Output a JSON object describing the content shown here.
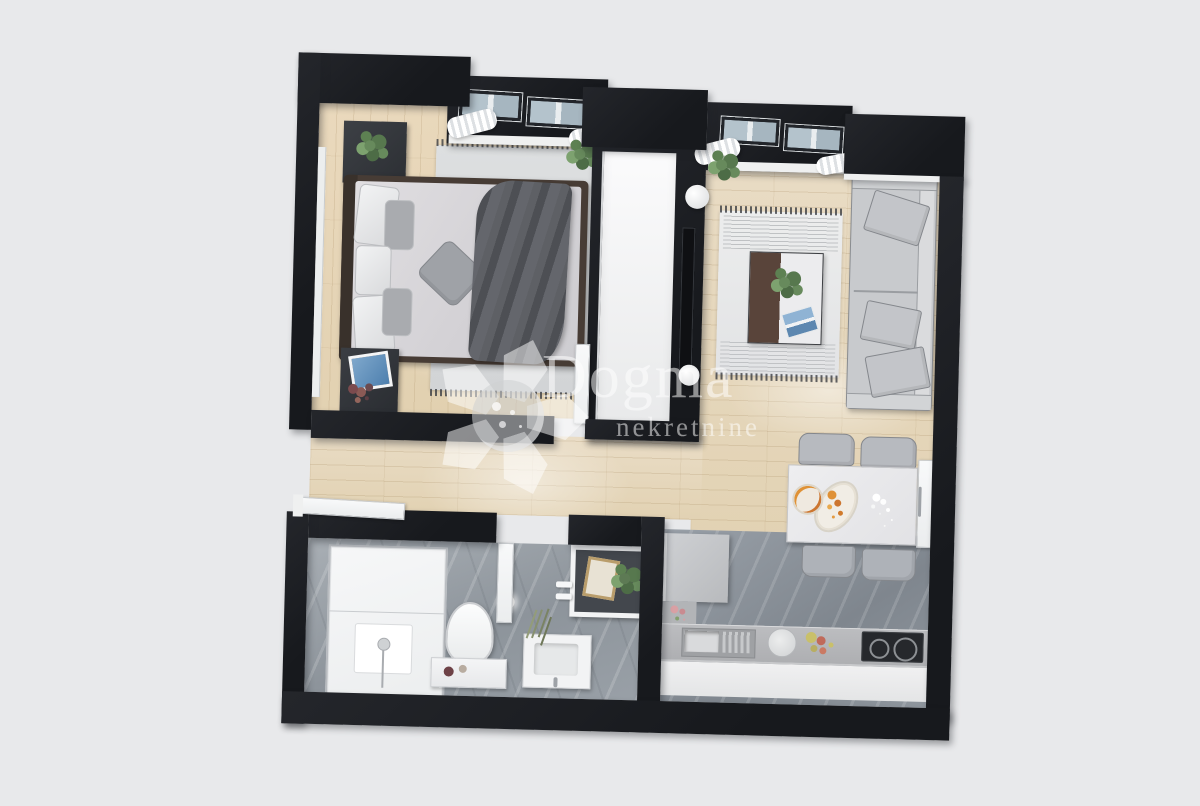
{
  "watermark": {
    "brand": "Dogma",
    "tagline": "nekretnine"
  },
  "palette": {
    "background": "#e8e9eb",
    "wall": "#1d1f24",
    "wood_floor": "#e6d9c1",
    "stone_floor": "#99a0a7",
    "shower_white": "#f3f4f5",
    "sofa_gray": "#c8cacd",
    "bed_duvet": "#dad8db",
    "blanket_dark": "#55575c",
    "plant_green": "#5f7d57",
    "food_orange": "#df9136",
    "magazine_blue": "#6c9ac8",
    "watermark_white": "rgba(255,255,255,0.52)"
  },
  "scene": {
    "type": "3d-floor-plan-render",
    "rooms": [
      {
        "id": "bedroom",
        "items": [
          "double-bed",
          "pillows",
          "throw-blanket",
          "accent-cushion",
          "area-rug",
          "planter-box",
          "nightstand",
          "picture-frame",
          "dried-flowers",
          "window",
          "curtains",
          "door"
        ]
      },
      {
        "id": "living-room",
        "items": [
          "sofa",
          "back-cushions",
          "area-rug",
          "coffee-table",
          "plant-bouquet",
          "magazine",
          "wall-tv",
          "window",
          "curtains",
          "potted-plant",
          "vases"
        ]
      },
      {
        "id": "dining-area",
        "items": [
          "dining-table",
          "chairs",
          "serving-platter",
          "plate",
          "flower-vase",
          "terrace-door"
        ]
      },
      {
        "id": "kitchen",
        "items": [
          "refrigerator",
          "flower-shelf",
          "countertop",
          "sink",
          "drainer",
          "cutting-board",
          "fruit-bowl",
          "induction-cooktop"
        ]
      },
      {
        "id": "bathroom",
        "items": [
          "walk-in-shower",
          "shower-column",
          "toilet",
          "cabinet",
          "vanity-sink",
          "ceiling-light",
          "dried-plant",
          "towel-hooks",
          "art-niche",
          "door"
        ]
      },
      {
        "id": "hallway",
        "items": [
          "entry-door",
          "wood-floor"
        ]
      }
    ]
  }
}
